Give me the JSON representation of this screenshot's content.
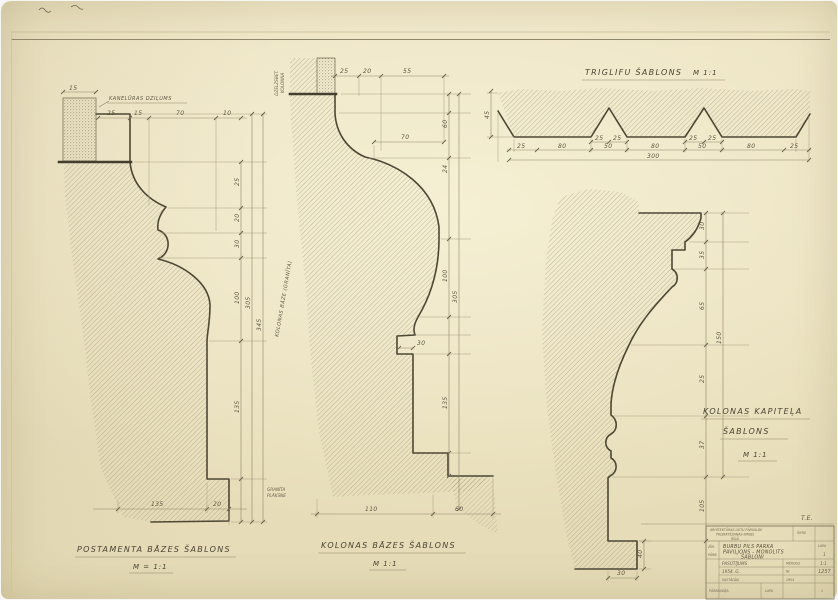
{
  "sheet": {
    "corner_note": "T.E."
  },
  "postament": {
    "title": "POSTAMENTA BĀZES ŠABLONS",
    "scale": "M = 1:1",
    "note": "KANELŪRAS DZIĻUMS",
    "dim_flute": "15",
    "dims_top": [
      "25",
      "15",
      "70",
      "10"
    ],
    "dims_right": [
      "25",
      "20",
      "30",
      "100",
      "135"
    ],
    "total_1": "305",
    "total_2": "345",
    "dims_bottom": [
      "135",
      "20"
    ]
  },
  "kolona": {
    "title": "KOLONAS BĀZES ŠABLONS",
    "scale": "M 1:1",
    "side_note": "KOLONAS BĀZE (GRANĪTA)",
    "top_note_1": "DZELZSBET.",
    "top_note_2": "KOLONNA",
    "foot_note_1": "GRANĪTA",
    "foot_note_2": "PLĀKSNE",
    "dims_top": [
      "25",
      "20",
      "55"
    ],
    "dim_width": "70",
    "dim_notch": "30",
    "dims_right": [
      "60",
      "24",
      "100",
      "135"
    ],
    "total_1": "305",
    "dims_bottom": [
      "110",
      "60"
    ]
  },
  "kapitelis": {
    "title_1": "KOLONAS KAPITEĻA",
    "title_2": "ŠABLONS",
    "scale": "M 1:1",
    "dims_right": [
      "30",
      "35",
      "65",
      "25",
      "37",
      "105"
    ],
    "total": "150",
    "dim_bottom": "30",
    "dim_foot": "40"
  },
  "triglifs": {
    "title": "TRIGLIFU ŠABLONS",
    "scale": "M 1:1",
    "dim_height": "45",
    "dims_row": [
      "25",
      "80",
      "50",
      "80",
      "50",
      "80",
      "25"
    ],
    "dims_pairs": [
      "25",
      "25",
      "25",
      "25"
    ],
    "dim_total": "300"
  },
  "title_block": {
    "org_1": "ARHITEKTŪRAS LIETU PĀRVALDE",
    "org_2": "PROJEKTĒŠANAS BIROJS",
    "org_3": "RĪGĀ",
    "code": "ŠIFRS",
    "left_1": "ZĪM.",
    "left_2": "PĀRB.",
    "project_1": "BURBU PILS PARKA",
    "project_2": "PAVILJONS - MONOLITS",
    "project_3": "ŠABLONI",
    "sheet_label": "LAPA",
    "sheet_no": "1",
    "row_order": "PASŪTĪJUMS",
    "scale_label": "MĒROGS",
    "row_scale": "1:1",
    "row_year": "1954. G.",
    "no_label": "Nr.",
    "row_number": "1257",
    "sig_1": "SASTĀDĪJA",
    "sig_date": "1954",
    "sig_2": "PĀRBAUDĪJA"
  }
}
